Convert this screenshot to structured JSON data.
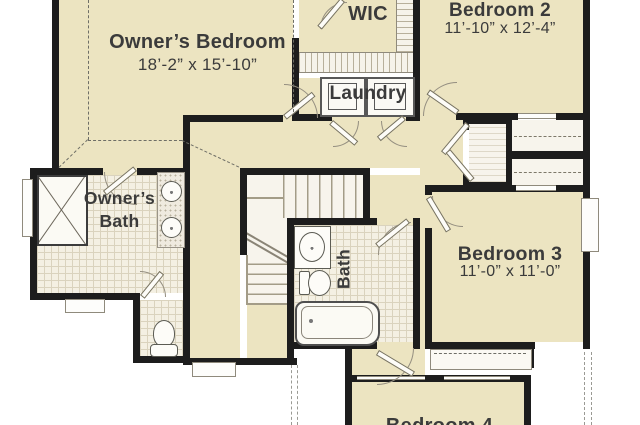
{
  "rooms": {
    "owners_bedroom": {
      "name": "Owner’s Bedroom",
      "dims": "18’-2” x 15’-10”"
    },
    "wic": {
      "name": "WIC"
    },
    "bedroom_2": {
      "name": "Bedroom 2",
      "dims": "11’-10” x 12’-4”"
    },
    "laundry": {
      "name": "Laundry"
    },
    "owners_bath": {
      "line1": "Owner’s",
      "line2": "Bath"
    },
    "hall_bath": {
      "name": "Bath"
    },
    "bedroom_3": {
      "name": "Bedroom 3",
      "dims": "11’-0” x 11’-0”"
    },
    "bedroom_4": {
      "name": "Bedroom 4"
    }
  },
  "colors": {
    "floor": "#ece4c1",
    "wall": "#1d1d1d",
    "tile": "#f4f0e3",
    "text": "#3b3b3b"
  }
}
